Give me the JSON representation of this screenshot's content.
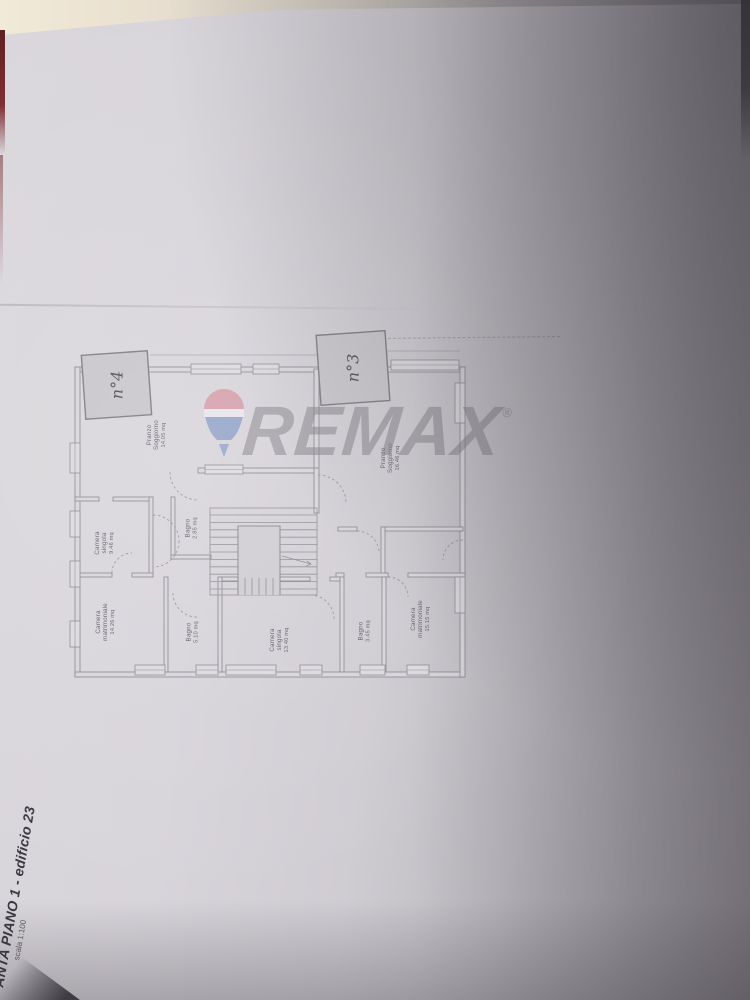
{
  "title_block": {
    "title": "ANTA PIANO 1 - edificio 23",
    "scale": "scala 1:100"
  },
  "watermark": {
    "brand": "REMAX",
    "registered": "®",
    "balloon_red": "#d48f9b",
    "balloon_blue": "#8093c3",
    "text_gray": "#7c7880"
  },
  "units": {
    "unit4": "n°4",
    "unit3": "n°3"
  },
  "rooms": {
    "soggiorno_left": {
      "line1": "Pranzo",
      "line2": "Soggiorno",
      "area": "14.05 mq"
    },
    "camera_singola_left": {
      "line1": "Camera",
      "line2": "singola",
      "area": "9.46 mq"
    },
    "bagno_small_left": {
      "line1": "Bagno",
      "area": "2.85 mq"
    },
    "camera_matrimoniale_left": {
      "line1": "Camera",
      "line2": "matrimoniale",
      "area": "14.26 mq"
    },
    "bagno_left": {
      "line1": "Bagno",
      "area": "5.10 mq"
    },
    "soggiorno_right": {
      "line1": "Pranzo",
      "line2": "Soggiorno",
      "area": "16.46 mq"
    },
    "camera_singola_right": {
      "line1": "Camera",
      "line2": "singola",
      "area": "13.40 mq"
    },
    "bagno_right": {
      "line1": "Bagno",
      "area": "3.45 mq"
    },
    "camera_matrimoniale_right": {
      "line1": "Camera",
      "line2": "matrimoniale",
      "area": "15.15 mq"
    }
  },
  "colors": {
    "paper": "#d6d3d9",
    "wall_line": "#8b888f",
    "marker_fill": "#c8c5ca"
  }
}
